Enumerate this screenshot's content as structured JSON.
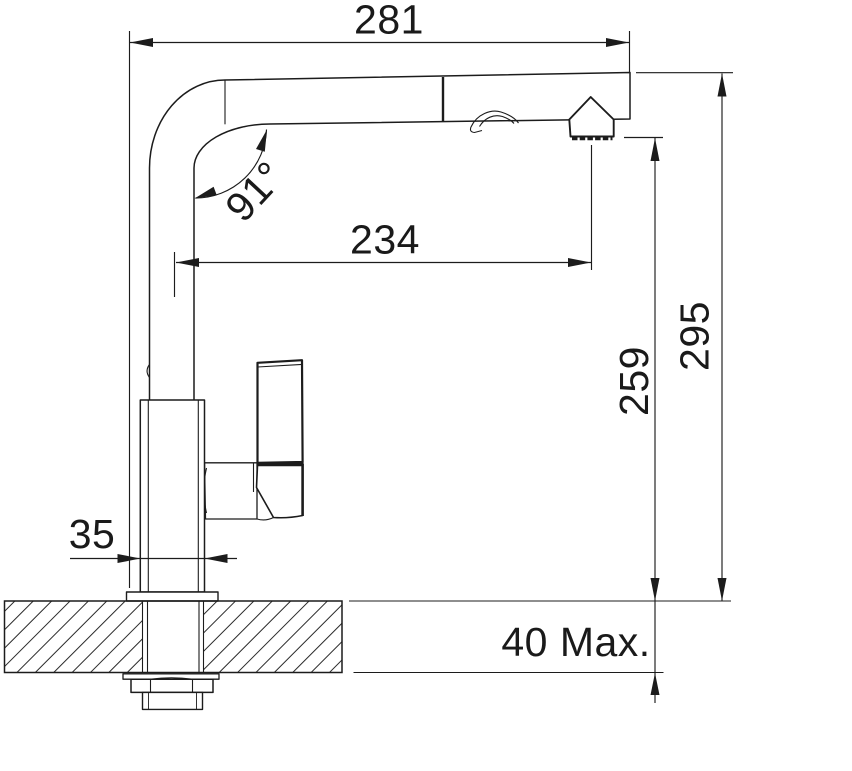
{
  "dims": {
    "spout_reach": "281",
    "spout_angle": "91°",
    "outlet_reach": "234",
    "outlet_height": "259",
    "total_height": "295",
    "body_width": "35",
    "deck_thickness": "40 Max."
  },
  "colors": {
    "line": "#1c1c1c",
    "text": "#1a1a1a",
    "background": "#ffffff"
  }
}
